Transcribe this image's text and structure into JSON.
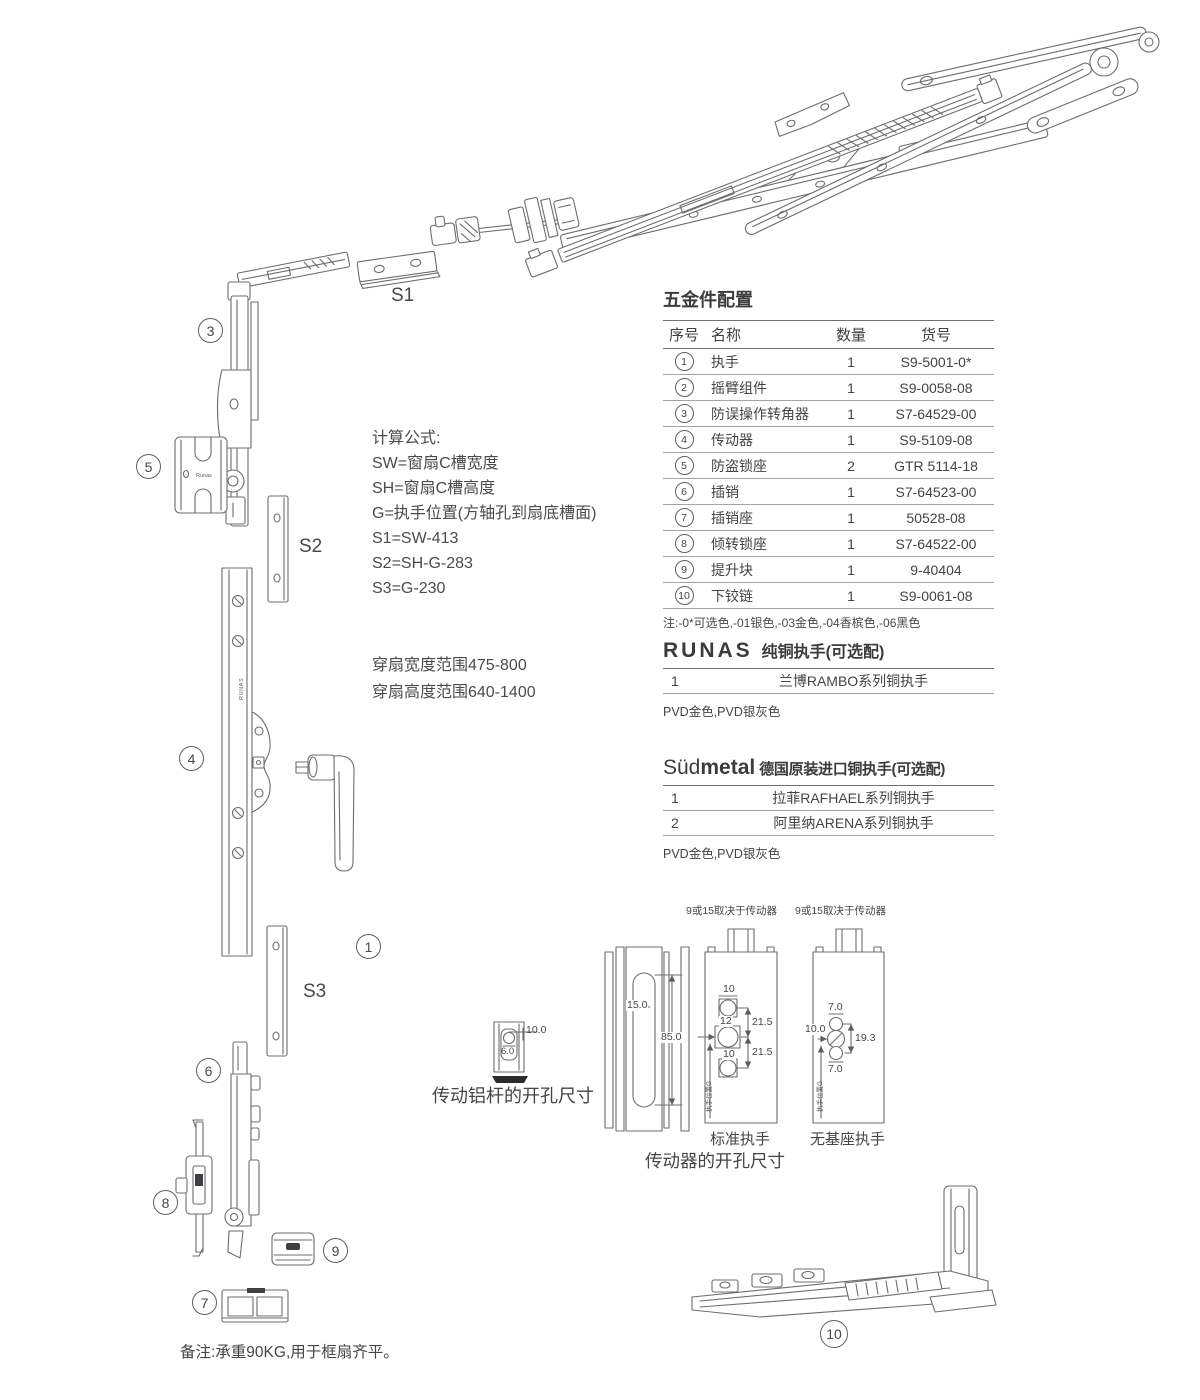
{
  "marks": {
    "keeper": "Runas",
    "bar": "RUNAS"
  },
  "labels": {
    "s1": "S1",
    "s2": "S2",
    "s3": "S3"
  },
  "callouts": {
    "c1": "1",
    "c3": "3",
    "c4": "4",
    "c5": "5",
    "c6": "6",
    "c7": "7",
    "c8": "8",
    "c9": "9",
    "c10": "10"
  },
  "formulas": {
    "title": "计算公式:",
    "lines": [
      "SW=窗扇C槽宽度",
      "SH=窗扇C槽高度",
      "G=执手位置(方轴孔到扇底槽面)",
      "S1=SW-413",
      "S2=SH-G-283",
      "S3=G-230"
    ]
  },
  "range": {
    "line1": "穿扇宽度范围475-800",
    "line2": "穿扇高度范围640-1400"
  },
  "parts_table": {
    "title": "五金件配置",
    "headers": {
      "index": "序号",
      "name": "名称",
      "qty": "数量",
      "code": "货号"
    },
    "rows": [
      {
        "num": "1",
        "name": "执手",
        "qty": "1",
        "code": "S9-5001-0*"
      },
      {
        "num": "2",
        "name": "摇臂组件",
        "qty": "1",
        "code": "S9-0058-08"
      },
      {
        "num": "3",
        "name": "防误操作转角器",
        "qty": "1",
        "code": "S7-64529-00"
      },
      {
        "num": "4",
        "name": "传动器",
        "qty": "1",
        "code": "S9-5109-08"
      },
      {
        "num": "5",
        "name": "防盗锁座",
        "qty": "2",
        "code": "GTR 5114-18"
      },
      {
        "num": "6",
        "name": "插销",
        "qty": "1",
        "code": "S7-64523-00"
      },
      {
        "num": "7",
        "name": "插销座",
        "qty": "1",
        "code": "50528-08"
      },
      {
        "num": "8",
        "name": "倾转锁座",
        "qty": "1",
        "code": "S7-64522-00"
      },
      {
        "num": "9",
        "name": "提升块",
        "qty": "1",
        "code": "9-40404"
      },
      {
        "num": "10",
        "name": "下铰链",
        "qty": "1",
        "code": "S9-0061-08"
      }
    ],
    "note": "注:-0*可选色,-01银色,-03金色,-04香槟色,-06黑色"
  },
  "runas": {
    "brand": "RUNAS",
    "title": "纯铜执手(可选配)",
    "rows": [
      {
        "num": "1",
        "name": "兰博RAMBO系列铜执手"
      }
    ],
    "note": "PVD金色,PVD银灰色"
  },
  "sudmetal": {
    "brand_a": "Süd",
    "brand_b": "metal",
    "title": "德国原装进口铜执手(可选配)",
    "rows": [
      {
        "num": "1",
        "name": "拉菲RAFHAEL系列铜执手"
      },
      {
        "num": "2",
        "name": "阿里纳ARENA系列铜执手"
      }
    ],
    "note": "PVD金色,PVD银灰色"
  },
  "alu_rod": {
    "dim_w": "10.0",
    "dim_h": "6.0",
    "caption": "传动铝杆的开孔尺寸"
  },
  "driver": {
    "caption": "传动器的开孔尺寸",
    "profile": {
      "slot": "15.0",
      "length": "85.0"
    },
    "standard": {
      "header": "9或15取决于传动器",
      "top": "10",
      "mid": "12",
      "bottom": "10",
      "right_top": "21.5",
      "right_bottom": "21.5",
      "axis": "执手位置G",
      "label": "标准执手"
    },
    "no_base": {
      "header": "9或15取决于传动器",
      "top": "7.0",
      "left": "10.0",
      "right": "19.3",
      "bottom": "7.0",
      "axis": "执手位置G",
      "label": "无基座执手"
    }
  },
  "footer": {
    "note": "备注:承重90KG,用于框扇齐平。"
  }
}
